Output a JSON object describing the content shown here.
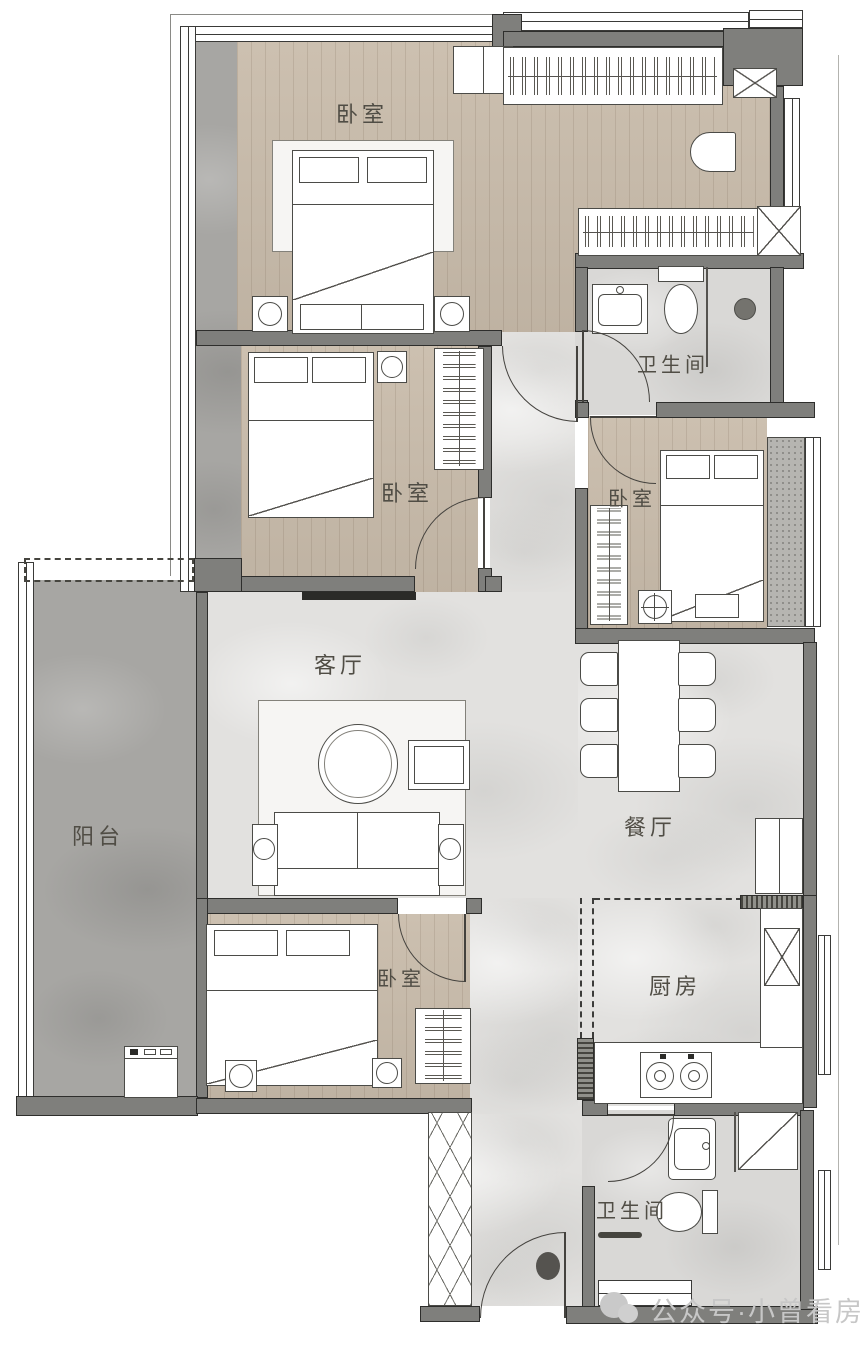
{
  "plan": {
    "type": "residential-floor-plan",
    "rooms": {
      "bedroom_master": {
        "label": "卧室"
      },
      "bedroom_second": {
        "label": "卧室"
      },
      "bedroom_third": {
        "label": "卧室"
      },
      "bedroom_fourth": {
        "label": "卧室"
      },
      "bathroom_master": {
        "label": "卫生间"
      },
      "bathroom_common": {
        "label": "卫生间"
      },
      "living_room": {
        "label": "客厅"
      },
      "dining_room": {
        "label": "餐厅"
      },
      "kitchen": {
        "label": "厨房"
      },
      "balcony": {
        "label": "阳台"
      }
    },
    "colors": {
      "wall": "#7f7f7c",
      "wood_floor": "#c9bcab",
      "marble_floor": "#e2e1df",
      "tile_floor": "#d9d8d6",
      "balcony_stone": "#a7a6a3",
      "outline": "#2e2e2c",
      "watermark": "#c7c7c7"
    }
  },
  "watermark": {
    "text": "公众号·小曾看房",
    "icon": "wechat-official-account-icon"
  }
}
